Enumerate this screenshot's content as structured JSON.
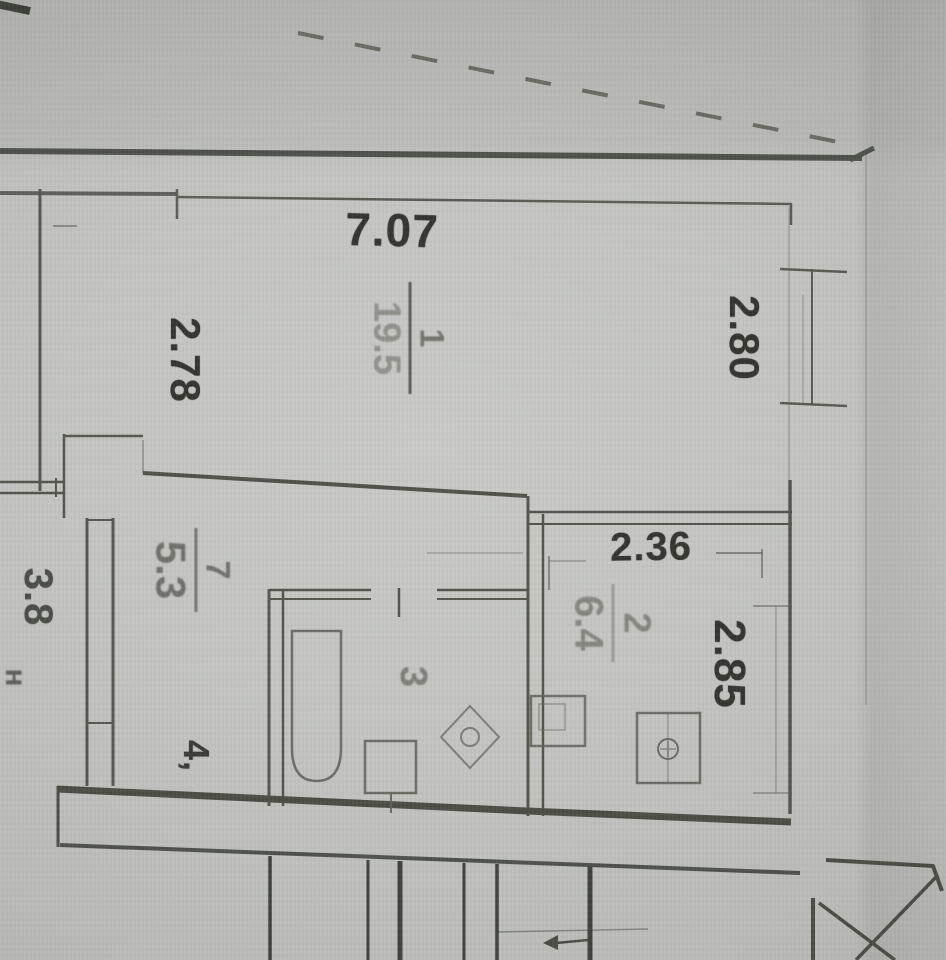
{
  "document": {
    "type": "scanned apartment floor plan"
  },
  "palette": {
    "paper": "#c3c4c0",
    "paper_dark": "#b2b3af",
    "line": "#54564e",
    "line_soft": "#7a7c74",
    "text_dark": "#34352f",
    "text_soft": "#8b8d85"
  },
  "dimensions": {
    "room1_width": "7.07",
    "room1_depth": "2.78",
    "room1_right": "2.80",
    "kitchen_width": "2.36",
    "kitchen_depth": "2.85"
  },
  "rooms": {
    "living": {
      "number": "1",
      "area": "19.5"
    },
    "kitchen": {
      "number": "2",
      "area": "6.4"
    },
    "bathroom": {
      "number": "3"
    },
    "corridor": {
      "number": "4,"
    },
    "hall": {
      "number": "7",
      "area": "5.3"
    },
    "neighbor": {
      "area": "3.8",
      "note": "н"
    }
  },
  "icons": {
    "fixtures": [
      "bathtub-icon",
      "toilet-icon",
      "washbasin-icon",
      "kitchen-sink-icon",
      "stove-icon",
      "elevator-icon",
      "stairs-lines"
    ]
  }
}
